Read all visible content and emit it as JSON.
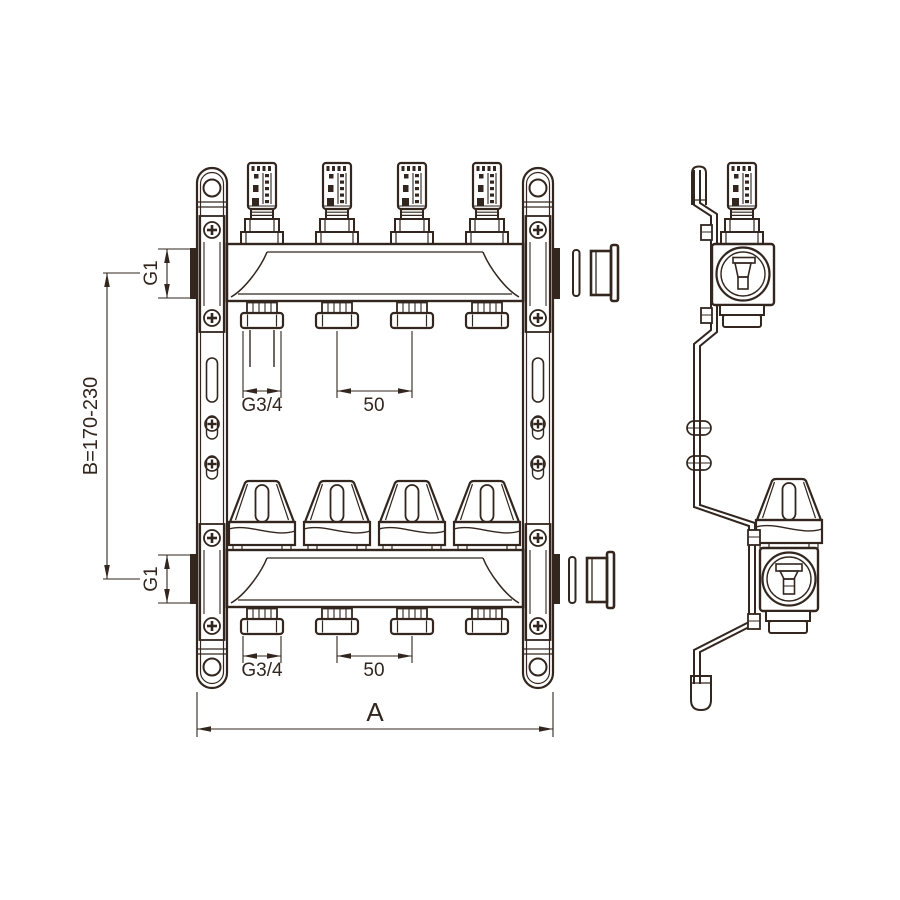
{
  "colors": {
    "line": "#32261f",
    "background": "#ffffff"
  },
  "front_view": {
    "dim_port_top": "G1",
    "dim_port_bottom": "G1",
    "dim_outlet_thread_top": "G3/4",
    "dim_outlet_thread_bottom": "G3/4",
    "dim_outlet_spacing_top": "50",
    "dim_outlet_spacing_bottom": "50",
    "dim_height": "B=170-230",
    "dim_width": "A"
  }
}
